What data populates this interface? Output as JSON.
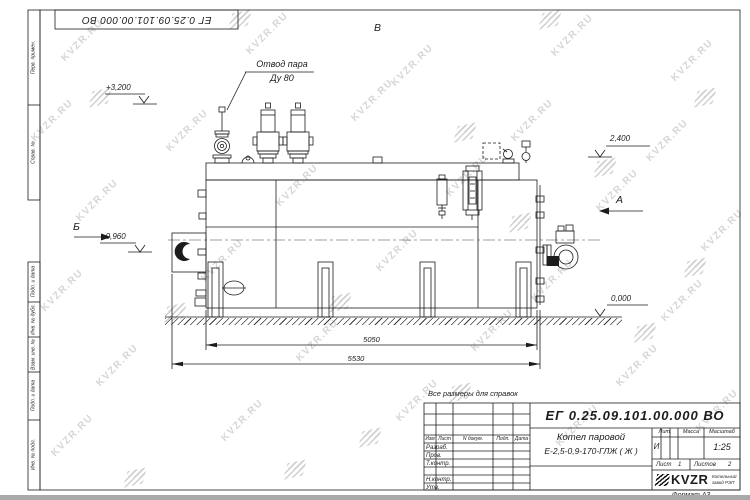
{
  "watermark": {
    "text": "KVZR.RU"
  },
  "top_stamp": {
    "designation": "ЕГ 0.25.09.101.00.000  ВО"
  },
  "side_columns": {
    "perv_primen": "Перв. примен.",
    "sprav": "Справ. №",
    "podp_data_1": "Подп. и дата",
    "inv_dubl": "Инв. № дубл.",
    "vzam_inv": "Взам. инв. №",
    "podp_data_2": "Подп. и дата",
    "inv_podl": "Инв. № подл."
  },
  "drawing": {
    "steam_outlet_label_line1": "Отвод пара",
    "steam_outlet_label_line2": "Ду 80",
    "view_top": "В",
    "view_left": "Б",
    "view_right": "А",
    "elevation_top_left": "+3,200",
    "elevation_top_right": "2,400",
    "elevation_burner": "+0,960",
    "elevation_ground": "0,000",
    "dim_inner": "5050",
    "dim_outer": "5530"
  },
  "note": "Все размеры для справок",
  "title_block": {
    "designation": "ЕГ 0.25.09.101.00.000  ВО",
    "product_line1": "Котел паровой",
    "product_line2": "Е-2,5-0,9-170-ГЛЖ ( Ж )",
    "col_izm": "Изм",
    "col_list": "Лист",
    "col_docum": "N докум.",
    "col_podp": "Подп.",
    "col_data": "Дата",
    "row_razrab": "Разраб.",
    "row_prov": "Пров.",
    "row_tkontr": "Т.контр.",
    "row_nkontr": "Н.контр.",
    "row_utv": "Утв.",
    "lit_label": "Лит.",
    "mass_label": "Масса",
    "scale_label": "Масштаб",
    "lit_value": "И",
    "scale_value": "1:25",
    "sheet_label": "Лист",
    "sheet_value": "1",
    "sheets_label": "Листов",
    "sheets_value": "2",
    "logo_text": "KVZR",
    "company_line1": "Котельный",
    "company_line2": "завод РЭП",
    "format_note": "Формат А3"
  }
}
